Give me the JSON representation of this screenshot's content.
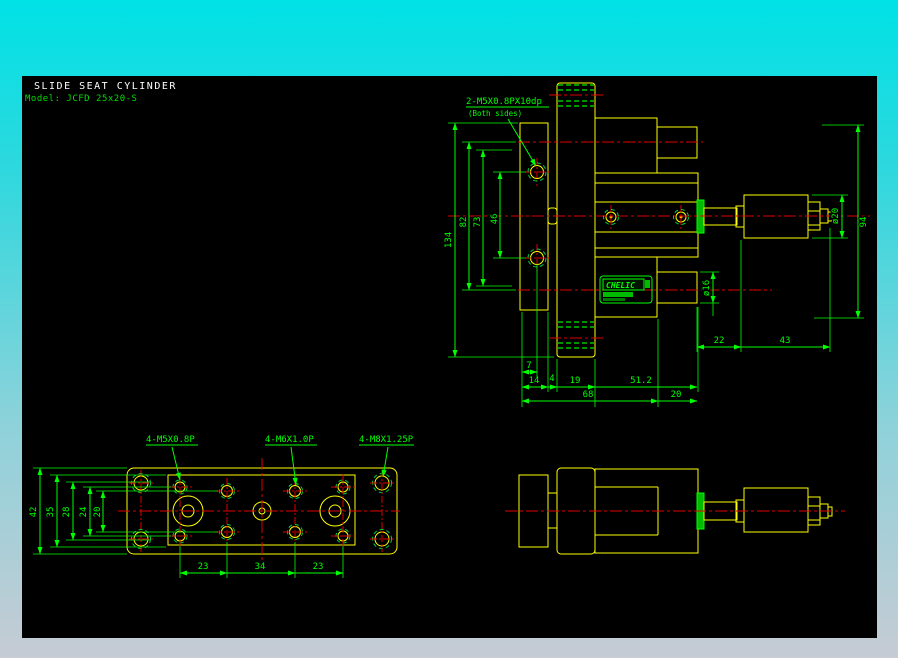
{
  "header": {
    "title": "SLIDE SEAT CYLINDER",
    "model": "Model: JCFD 25x20-S"
  },
  "notes": {
    "thread_note": "2-M5X0.8PX10dp",
    "thread_note_sub": "(Both sides)"
  },
  "plan_labels": {
    "m5": "4-M5X0.8P",
    "m6": "4-M6X1.0P",
    "m8": "4-M8X1.25P"
  },
  "logo": {
    "brand": "CHELIC"
  },
  "dims": {
    "front": {
      "h134": "134",
      "h82": "82",
      "h73": "73",
      "h46": "46",
      "dia20": "ø20",
      "h94": "94",
      "dia16": "ø16",
      "w22": "22",
      "w43": "43",
      "w7": "7",
      "w14": "14",
      "w4": "4",
      "w19": "19",
      "w51": "51.2",
      "w68": "68",
      "w20": "20"
    },
    "plan": {
      "h42": "42",
      "h35": "35",
      "h28": "28",
      "h24": "24",
      "h20": "20",
      "w23a": "23",
      "w34": "34",
      "w23b": "23"
    }
  },
  "colors": {
    "background": "#000000",
    "geometry": "#ffff00",
    "dimension": "#00ff00",
    "centerline": "#e00000",
    "hatch": "#ee00ee",
    "title": "#ffffff",
    "frame_top": "#00e2e6",
    "frame_bottom": "#c6cbd4"
  }
}
